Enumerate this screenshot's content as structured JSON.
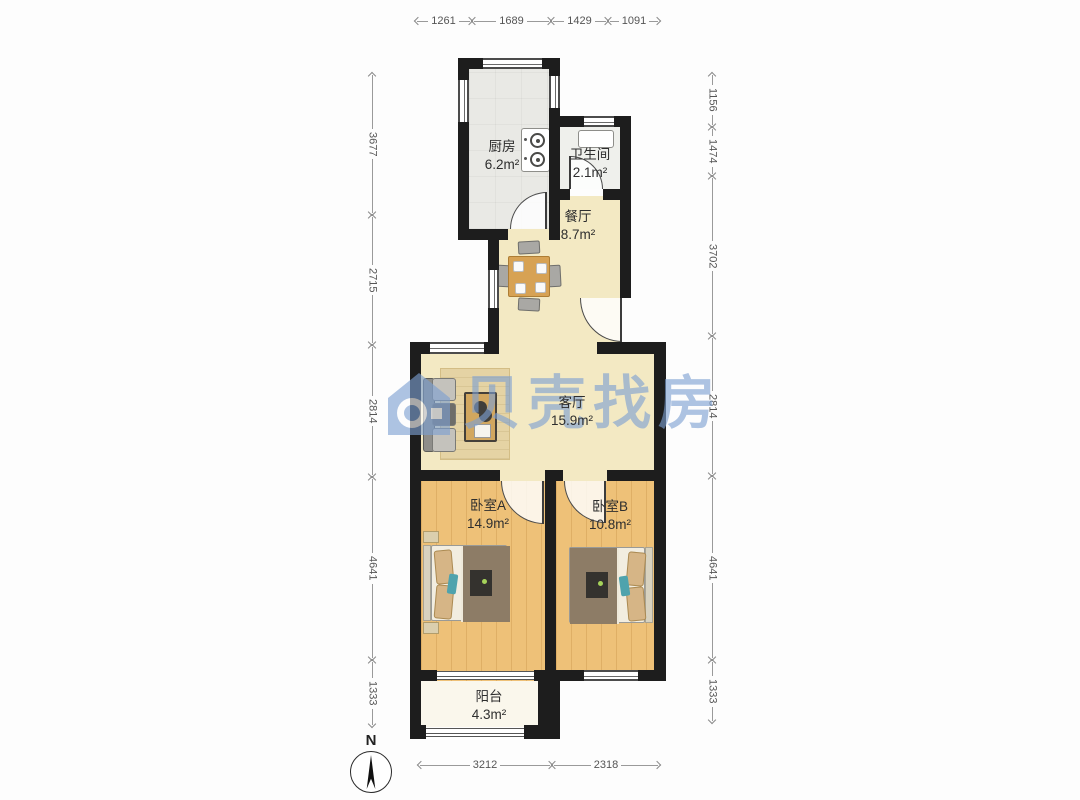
{
  "watermark": {
    "text": "贝壳找房",
    "color": "#7da0d2"
  },
  "compass": {
    "label": "N"
  },
  "rooms": {
    "kitchen": {
      "name": "厨房",
      "area": "6.2m²"
    },
    "bathroom": {
      "name": "卫生间",
      "area": "2.1m²"
    },
    "dining": {
      "name": "餐厅",
      "area": "8.7m²"
    },
    "living": {
      "name": "客厅",
      "area": "15.9m²"
    },
    "bedroom_a": {
      "name": "卧室A",
      "area": "14.9m²"
    },
    "bedroom_b": {
      "name": "卧室B",
      "area": "10.8m²"
    },
    "balcony": {
      "name": "阳台",
      "area": "4.3m²"
    }
  },
  "dimensions": {
    "top": [
      "1261",
      "1689",
      "1429",
      "1091"
    ],
    "bottom": [
      "3212",
      "2318"
    ],
    "left": [
      "3677",
      "2715",
      "2814",
      "4641",
      "1333"
    ],
    "right": [
      "1156",
      "1474",
      "3702",
      "2814",
      "4641",
      "1333"
    ]
  },
  "colors": {
    "wall": "#1d1d1d",
    "floor_cream": "#f3e9c3",
    "floor_wood": "#eec178",
    "floor_kitchen": "#e9e9e5",
    "floor_balcony": "#faf7ec",
    "watermark_blue": "#7da0d2"
  }
}
